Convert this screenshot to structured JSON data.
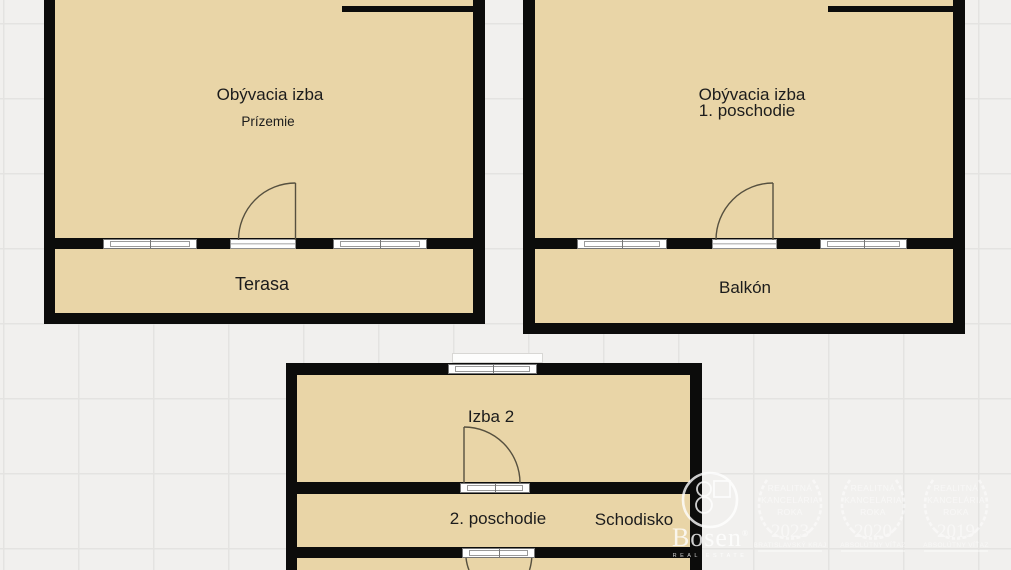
{
  "plans": {
    "ground": {
      "room": "Obývacia izba",
      "floor": "Prízemie",
      "outdoor": "Terasa"
    },
    "first": {
      "room": "Obývacia izba",
      "floor": "1. poschodie",
      "outdoor": "Balkón"
    },
    "second": {
      "room": "Izba 2",
      "floor": "2. poschodie",
      "stairs": "Schodisko"
    }
  },
  "watermark": {
    "brand": "Bosen",
    "registered": "®",
    "tagline": "REAL ESTATE",
    "awards": [
      {
        "line1": "REALITNÁ",
        "line2": "KANCELÁRIA",
        "line3": "ROKA",
        "year": "2023",
        "winner": "BRATISLAVSKÝ KRAJ"
      },
      {
        "line1": "REALITNÁ",
        "line2": "KANCELÁRIA",
        "line3": "ROKA",
        "year": "2020",
        "winner": "ABSOLÚTNY VÍŤAZ"
      },
      {
        "line1": "REALITNÁ",
        "line2": "KANCELÁRIA",
        "line3": "ROKA",
        "year": "2019",
        "winner": "ABSOLÚTNY VÍŤAZ"
      }
    ]
  },
  "colors": {
    "background": "#f1f0ee",
    "grid_line": "#e4e3e1",
    "room_fill": "#e9d5a7",
    "wall": "#0c0c0b",
    "door_line": "#56503f",
    "watermark": "#ffffff"
  }
}
